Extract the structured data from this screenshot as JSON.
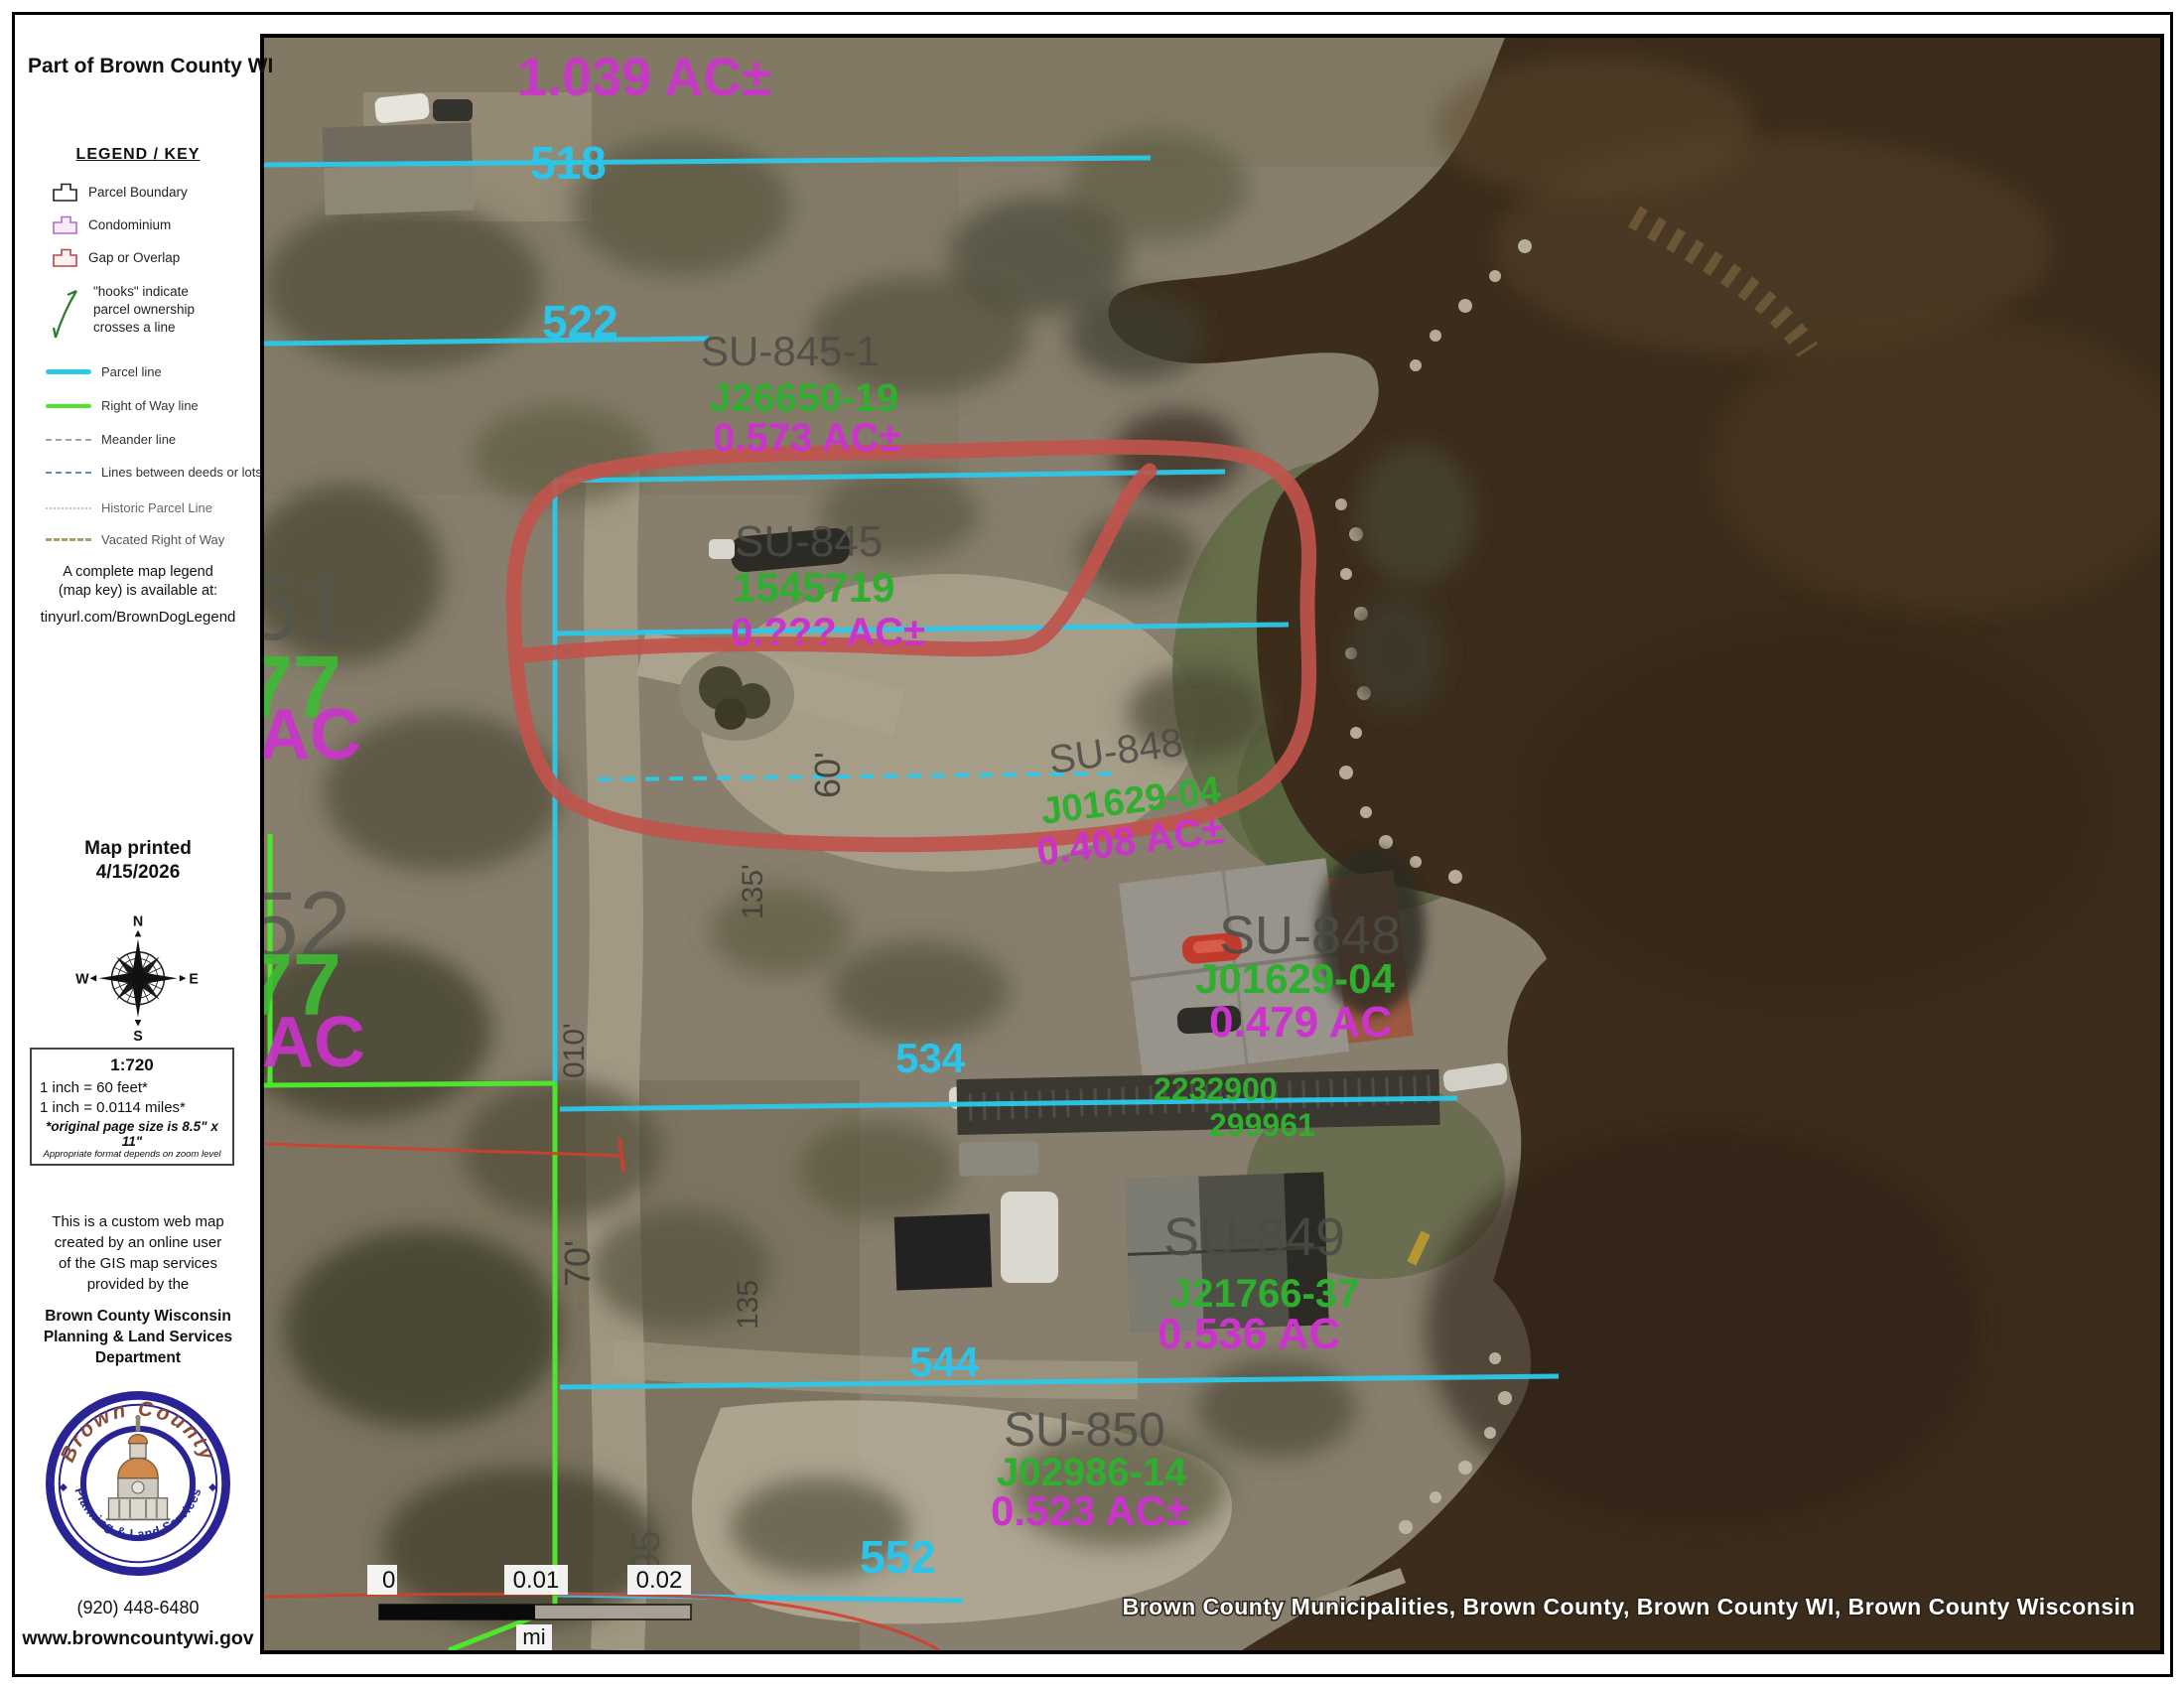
{
  "title": "Part of Brown County WI",
  "legend": {
    "heading": "LEGEND / KEY",
    "items": [
      {
        "label": "Parcel Boundary"
      },
      {
        "label": "Condominium"
      },
      {
        "label": "Gap or Overlap"
      },
      {
        "label": "Parcel line"
      },
      {
        "label": "Right of Way line"
      },
      {
        "label": "Meander line"
      },
      {
        "label": "Lines between deeds or lots"
      },
      {
        "label": "Historic Parcel Line"
      },
      {
        "label": "Vacated Right of Way"
      }
    ],
    "hooks_lines": [
      "\"hooks\" indicate",
      "parcel ownership",
      "crosses a line"
    ],
    "note_lines": [
      "A complete map legend",
      "(map key) is available at:",
      "tinyurl.com/BrownDogLegend"
    ]
  },
  "printed": {
    "line1": "Map printed",
    "line2": "4/15/2026"
  },
  "compass": {
    "n": "N",
    "e": "E",
    "s": "S",
    "w": "W"
  },
  "scale": {
    "ratio": "1:720",
    "feet": "1 inch = 60 feet*",
    "miles": "1 inch = 0.0114 miles*",
    "page_note": "*original page size is 8.5\" x 11\"",
    "format_note": "Appropriate format depends on zoom level"
  },
  "about": {
    "lines": [
      "This is a custom web map",
      "created by an online user",
      "of the GIS map services",
      "provided by the"
    ],
    "dept_lines": [
      "Brown County Wisconsin",
      "Planning & Land Services",
      "Department"
    ]
  },
  "logo": {
    "arc_top": "Brown County",
    "arc_bottom": "Planning & Land Services"
  },
  "contact": {
    "phone": "(920) 448-6480",
    "website": "www.browncountywi.gov"
  },
  "map": {
    "attribution": "Brown County Municipalities, Brown County, Brown County WI, Brown County Wisconsin",
    "scalebar": {
      "t0": "0",
      "t1": "0.01",
      "t2": "0.02",
      "unit": "mi"
    },
    "texts": [
      {
        "t": "1.039 AC±"
      },
      {
        "t": "518"
      },
      {
        "t": "SU-845-1"
      },
      {
        "t": "J26650-19"
      },
      {
        "t": "0.573 AC±"
      },
      {
        "t": "522"
      },
      {
        "t": "SU-845"
      },
      {
        "t": "1545719"
      },
      {
        "t": "0.??? AC±"
      },
      {
        "t": "SU-848"
      },
      {
        "t": "J01629-04"
      },
      {
        "t": "0.408 AC±"
      },
      {
        "t": "60'"
      },
      {
        "t": "135'"
      },
      {
        "t": "SU-848"
      },
      {
        "t": "J01629-04"
      },
      {
        "t": "0.479 AC"
      },
      {
        "t": "534"
      },
      {
        "t": "2232900"
      },
      {
        "t": "299961"
      },
      {
        "t": "010'"
      },
      {
        "t": "70'"
      },
      {
        "t": "135"
      },
      {
        "t": "SU-849"
      },
      {
        "t": "J21766-37"
      },
      {
        "t": "0.536 AC"
      },
      {
        "t": "544"
      },
      {
        "t": "SU-850"
      },
      {
        "t": "J02986-14"
      },
      {
        "t": "0.523 AC±"
      },
      {
        "t": "552"
      },
      {
        "t": "195"
      },
      {
        "t": "51"
      },
      {
        "t": "77"
      },
      {
        "t": "AC"
      },
      {
        "t": "52"
      },
      {
        "t": "77"
      },
      {
        "t": "AC"
      }
    ],
    "colors": {
      "parcel_line": "#2cc8ea",
      "right_of_way": "#4ee62c",
      "acreage_label": "#cc33cc",
      "document_label": "#2fae2f",
      "parcel_id_label": "#4c4c46",
      "highlight_annotation": "#c0544c",
      "water": "#3b2c1b"
    }
  }
}
